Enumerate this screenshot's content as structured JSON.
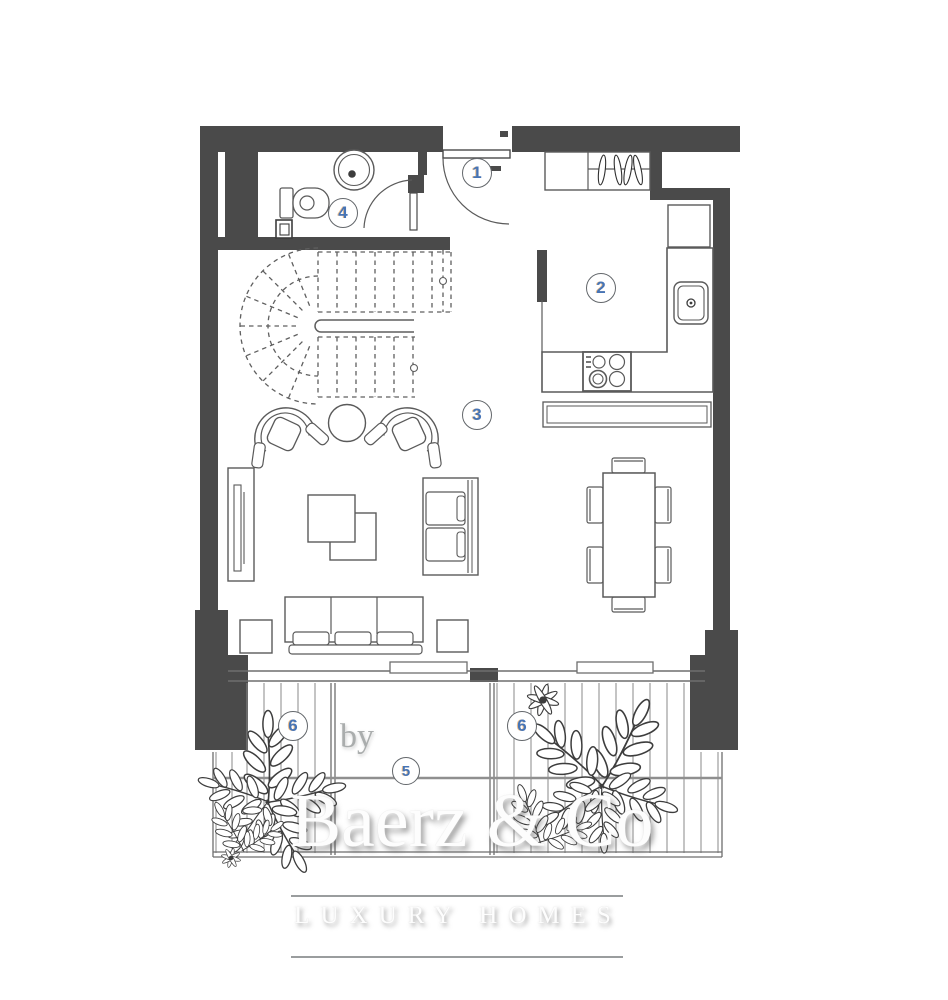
{
  "plan": {
    "rooms": [
      {
        "number": "1"
      },
      {
        "number": "2"
      },
      {
        "number": "3"
      },
      {
        "number": "4"
      },
      {
        "number": "5"
      },
      {
        "number": "6"
      },
      {
        "number": "6"
      }
    ],
    "watermark": {
      "by": "by",
      "brand": "Baerz & Co",
      "tagline": "LUXURY HOMES"
    },
    "colors": {
      "wall": "#4a4a4a",
      "furniture_line": "#5a5a5a",
      "stairs_dash": "#5f5f5f",
      "decking_line": "#8a8a8a",
      "room_number": "#4674b6",
      "watermark_rule": "#9a9d9e"
    }
  }
}
